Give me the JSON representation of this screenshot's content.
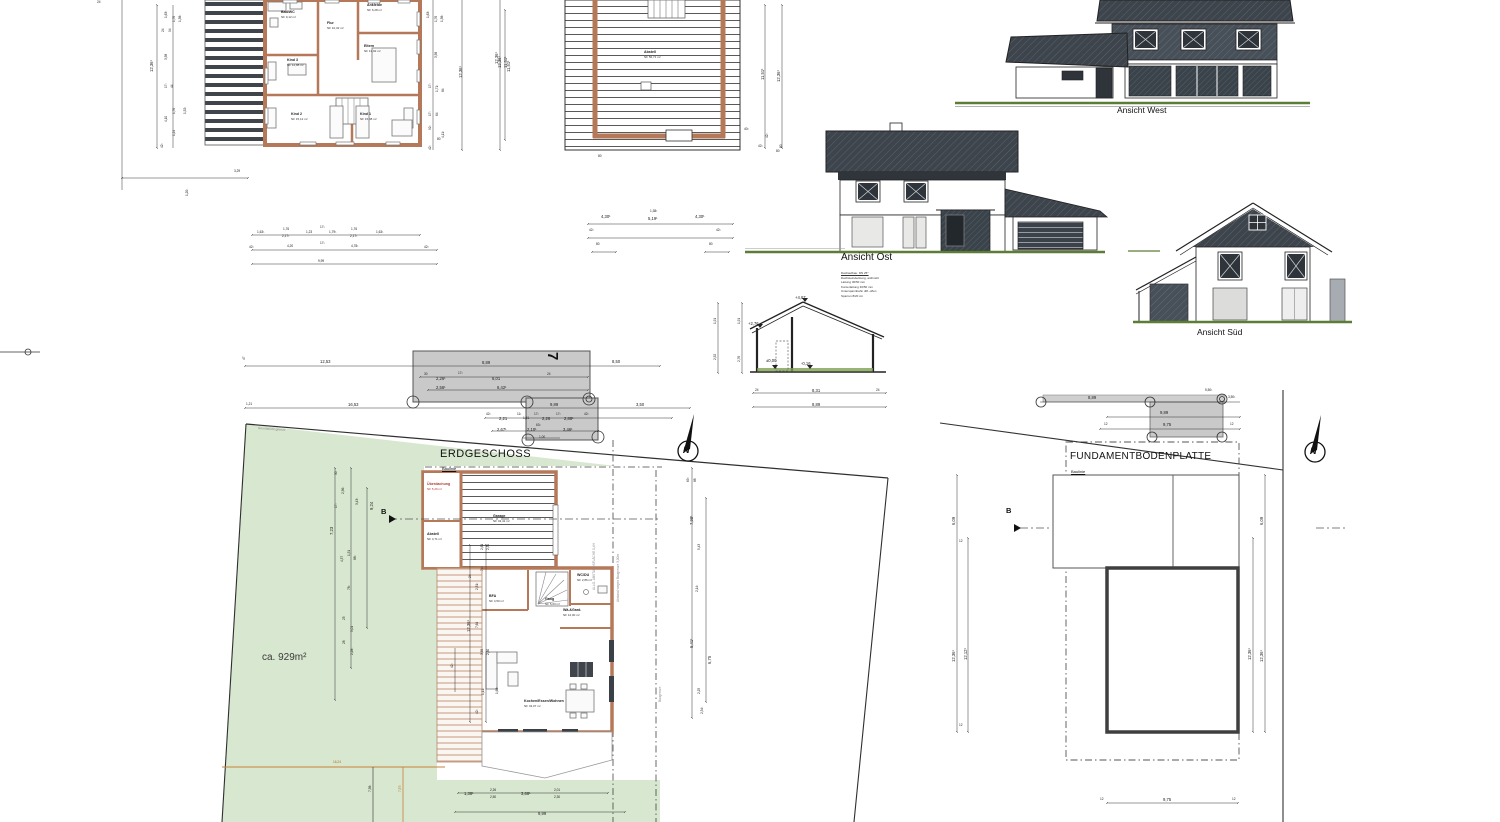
{
  "colors": {
    "wall_brown": "#b5795a",
    "roof_dark": "#3d444c",
    "plot_green": "#d8e7cf",
    "ground_green": "#5d7c37",
    "slab_gray": "#c9c9c9",
    "accent_orange": "#b06a1e",
    "accent_red": "#b03a2e"
  },
  "compass": {
    "letter": "N"
  },
  "og": {
    "rooms": [
      {
        "name": "Bad/WC",
        "area": "NF 9,12 m²"
      },
      {
        "name": "Flur",
        "area": "NF 10,32 m²"
      },
      {
        "name": "Ankleide",
        "area": "NF 6,28 m²"
      },
      {
        "name": "Eltern",
        "area": "NF 13,92 m²"
      },
      {
        "name": "Kind 3",
        "area": "NF 12,88 m²"
      },
      {
        "name": "Kind 2",
        "area": "NF 15,12 m²"
      },
      {
        "name": "Kind 1",
        "area": "NF 15,08 m²"
      }
    ],
    "dims": [
      {
        "t": "24",
        "x": 97,
        "y": 1,
        "c": "fs3"
      },
      {
        "t": "12,36¹",
        "x": 150,
        "y": 72,
        "r": -90
      },
      {
        "t": "3,58",
        "x": 165,
        "y": 60,
        "r": -90,
        "c": "fs3"
      },
      {
        "t": "24",
        "x": 162,
        "y": 32,
        "r": -90,
        "c": "fs3"
      },
      {
        "t": "94",
        "x": 169,
        "y": 32,
        "r": -90,
        "c": "fs3"
      },
      {
        "t": "1,63¹",
        "x": 165,
        "y": 18,
        "r": -90,
        "c": "fs3"
      },
      {
        "t": "1,76",
        "x": 173,
        "y": 22,
        "r": -90,
        "c": "fs3"
      },
      {
        "t": "1,38¹",
        "x": 179,
        "y": 22,
        "r": -90,
        "c": "fs3"
      },
      {
        "t": "17¹",
        "x": 165,
        "y": 88,
        "r": -90,
        "c": "fs3"
      },
      {
        "t": "44",
        "x": 171,
        "y": 88,
        "r": -90,
        "c": "fs3"
      },
      {
        "t": "4,10",
        "x": 165,
        "y": 122,
        "r": -90,
        "c": "fs3"
      },
      {
        "t": "1,76",
        "x": 173,
        "y": 114,
        "r": -90,
        "c": "fs3"
      },
      {
        "t": "1,52¹",
        "x": 184,
        "y": 114,
        "r": -90,
        "c": "fs3"
      },
      {
        "t": "1,24",
        "x": 173,
        "y": 136,
        "r": -90,
        "c": "fs3"
      },
      {
        "t": "42¹",
        "x": 161,
        "y": 148,
        "r": -90,
        "c": "fs3"
      },
      {
        "t": "1,20¹",
        "x": 186,
        "y": 196,
        "r": -90,
        "c": "fs3"
      },
      {
        "t": "3,29",
        "x": 234,
        "y": 170,
        "c": "fs3"
      },
      {
        "t": "80",
        "x": 437,
        "y": 138,
        "c": "fs3"
      },
      {
        "t": "1,63¹",
        "x": 427,
        "y": 18,
        "r": -90,
        "c": "fs3"
      },
      {
        "t": "1,76",
        "x": 435,
        "y": 22,
        "r": -90,
        "c": "fs3"
      },
      {
        "t": "1,38¹",
        "x": 441,
        "y": 22,
        "r": -90,
        "c": "fs3"
      },
      {
        "t": "3,58",
        "x": 435,
        "y": 58,
        "r": -90,
        "c": "fs3"
      },
      {
        "t": "17¹",
        "x": 429,
        "y": 88,
        "r": -90,
        "c": "fs3"
      },
      {
        "t": "1,71¹",
        "x": 436,
        "y": 92,
        "r": -90,
        "c": "fs3"
      },
      {
        "t": "84",
        "x": 442,
        "y": 92,
        "r": -90,
        "c": "fs3"
      },
      {
        "t": "17¹",
        "x": 429,
        "y": 116,
        "r": -90,
        "c": "fs3"
      },
      {
        "t": "64",
        "x": 436,
        "y": 116,
        "r": -90,
        "c": "fs3"
      },
      {
        "t": "92¹",
        "x": 429,
        "y": 130,
        "r": -90,
        "c": "fs3"
      },
      {
        "t": "4,11¹",
        "x": 442,
        "y": 138,
        "r": -90,
        "c": "fs3"
      },
      {
        "t": "42¹",
        "x": 429,
        "y": 150,
        "r": -90,
        "c": "fs3"
      },
      {
        "t": "12,36¹",
        "x": 459,
        "y": 78,
        "r": -90
      },
      {
        "t": "12,36¹",
        "x": 495,
        "y": 64,
        "r": -90
      },
      {
        "t": "11,51¹",
        "x": 504,
        "y": 68,
        "r": -90
      },
      {
        "t": "1,63¹",
        "x": 257,
        "y": 231,
        "c": "fs3"
      },
      {
        "t": "1,76",
        "x": 283,
        "y": 228,
        "c": "fs3"
      },
      {
        "t": "2,17¹",
        "x": 282,
        "y": 235,
        "c": "fs3"
      },
      {
        "t": "1,23",
        "x": 306,
        "y": 231,
        "c": "fs3"
      },
      {
        "t": "17¹",
        "x": 320,
        "y": 226,
        "c": "fs3"
      },
      {
        "t": "1,79¹",
        "x": 329,
        "y": 231,
        "c": "fs3"
      },
      {
        "t": "1,76",
        "x": 351,
        "y": 228,
        "c": "fs3"
      },
      {
        "t": "2,17¹",
        "x": 350,
        "y": 235,
        "c": "fs3"
      },
      {
        "t": "1,63¹",
        "x": 376,
        "y": 231,
        "c": "fs3"
      },
      {
        "t": "42¹",
        "x": 249,
        "y": 246,
        "c": "fs3"
      },
      {
        "t": "4,20",
        "x": 287,
        "y": 245,
        "c": "fs3"
      },
      {
        "t": "17¹",
        "x": 320,
        "y": 242,
        "c": "fs3"
      },
      {
        "t": "4,78¹",
        "x": 351,
        "y": 245,
        "c": "fs3"
      },
      {
        "t": "42¹",
        "x": 424,
        "y": 246,
        "c": "fs3"
      },
      {
        "t": "9,99",
        "x": 318,
        "y": 260,
        "c": "fs3"
      }
    ]
  },
  "dg": {
    "room": {
      "name": "Abstell",
      "area": "NF 56,71 m²"
    },
    "dims": [
      {
        "t": "12,36¹",
        "x": 498,
        "y": 68,
        "r": -90
      },
      {
        "t": "11,51¹",
        "x": 507,
        "y": 72,
        "r": -90
      },
      {
        "t": "11,51¹",
        "x": 761,
        "y": 80,
        "r": -90
      },
      {
        "t": "12,36¹",
        "x": 777,
        "y": 82,
        "r": -90
      },
      {
        "t": "42¹",
        "x": 758,
        "y": 145,
        "c": "fs3"
      },
      {
        "t": "80",
        "x": 776,
        "y": 150,
        "c": "fs3"
      },
      {
        "t": "80",
        "x": 598,
        "y": 155,
        "c": "fs3"
      },
      {
        "t": "40¹",
        "x": 744,
        "y": 128,
        "c": "fs3"
      }
    ]
  },
  "elevations": {
    "west": "Ansicht West",
    "ost": "Ansicht Ost",
    "sued": "Ansicht Süd",
    "ost_specs": [
      "Dachaufbau: DN 25°",
      "Dachsteindeckung, anthrazit",
      "Lattung 30/50 mm",
      "Konterlattung 30/50 mm",
      "Unterspannbahn diff.-offen",
      "Sparren 8/20 cm"
    ],
    "dims": [
      {
        "t": "4,30¹",
        "x": 601,
        "y": 215
      },
      {
        "t": "1,38¹",
        "x": 650,
        "y": 210,
        "c": "fs3"
      },
      {
        "t": "5,19¹",
        "x": 648,
        "y": 217
      },
      {
        "t": "4,30¹",
        "x": 695,
        "y": 215
      },
      {
        "t": "42¹",
        "x": 589,
        "y": 229,
        "c": "fs3"
      },
      {
        "t": "42¹",
        "x": 716,
        "y": 229,
        "c": "fs3"
      },
      {
        "t": "80",
        "x": 596,
        "y": 243,
        "c": "fs3"
      },
      {
        "t": "80",
        "x": 709,
        "y": 243,
        "c": "fs3"
      },
      {
        "t": "42¹",
        "x": 766,
        "y": 138,
        "r": -90,
        "c": "fs3"
      },
      {
        "t": "80",
        "x": 780,
        "y": 148,
        "r": -90,
        "c": "fs3"
      }
    ]
  },
  "section": {
    "levels": {
      "ridge": "+4,67",
      "eave": "+2,76",
      "floor": "±0,00",
      "ground": "-0,16"
    },
    "dims": [
      {
        "t": "1,91",
        "x": 714,
        "y": 324,
        "r": -90,
        "c": "fs3"
      },
      {
        "t": "2,52",
        "x": 714,
        "y": 360,
        "r": -90,
        "c": "fs3"
      },
      {
        "t": "1,91",
        "x": 738,
        "y": 324,
        "r": -90,
        "c": "fs3"
      },
      {
        "t": "2,76",
        "x": 738,
        "y": 362,
        "r": -90,
        "c": "fs3"
      },
      {
        "t": "24",
        "x": 755,
        "y": 389,
        "c": "fs3"
      },
      {
        "t": "8,31",
        "x": 812,
        "y": 389
      },
      {
        "t": "24",
        "x": 876,
        "y": 389,
        "c": "fs3"
      },
      {
        "t": "8,89",
        "x": 812,
        "y": 403
      }
    ]
  },
  "site": {
    "title": "ERDGESCHOSS",
    "baulinie": "Baulinie",
    "plot_area": "ca. 929m²",
    "neighbor_number": "7",
    "section_marker": "B",
    "rooms": [
      {
        "name": "Überdachung",
        "area": "NF 5,29 m²"
      },
      {
        "name": "Abstell",
        "area": "NF 4,71 m²"
      },
      {
        "name": "Garage",
        "area": "NF 43,41 m²"
      },
      {
        "name": "BFA",
        "area": "NF 4,50 m²"
      },
      {
        "name": "Gang",
        "area": "NF 5,03 m²"
      },
      {
        "name": "WC/DU",
        "area": "NF 2,86 m²"
      },
      {
        "name": "Wä.&Gard.",
        "area": "NF 12,00 m²"
      },
      {
        "name": "Kochen/Essen/Wohnen",
        "area": "NF 43,07 m²"
      }
    ],
    "dims": [
      {
        "t": "47",
        "x": 243,
        "y": 360,
        "r": -90,
        "c": "fs3"
      },
      {
        "t": "12,53",
        "x": 320,
        "y": 360
      },
      {
        "t": "8,89",
        "x": 482,
        "y": 361
      },
      {
        "t": "8,50",
        "x": 612,
        "y": 360
      },
      {
        "t": "30",
        "x": 424,
        "y": 373,
        "c": "fs3"
      },
      {
        "t": "2,26¹",
        "x": 436,
        "y": 377
      },
      {
        "t": "17¹",
        "x": 458,
        "y": 372,
        "c": "fs3"
      },
      {
        "t": "6,01",
        "x": 492,
        "y": 377
      },
      {
        "t": "24",
        "x": 547,
        "y": 373,
        "c": "fs3"
      },
      {
        "t": "2,56¹",
        "x": 436,
        "y": 386
      },
      {
        "t": "6,42¹",
        "x": 497,
        "y": 386
      },
      {
        "t": "1,21",
        "x": 246,
        "y": 403,
        "c": "fs3"
      },
      {
        "t": "16,53",
        "x": 348,
        "y": 403
      },
      {
        "t": "9,89",
        "x": 550,
        "y": 403
      },
      {
        "t": "3,50",
        "x": 636,
        "y": 403
      },
      {
        "t": "42¹",
        "x": 486,
        "y": 413,
        "c": "fs3"
      },
      {
        "t": "2,21",
        "x": 499,
        "y": 417
      },
      {
        "t": "11¹",
        "x": 517,
        "y": 413,
        "c": "fs3"
      },
      {
        "t": "1,61",
        "x": 523,
        "y": 417,
        "c": "fs3"
      },
      {
        "t": "17¹",
        "x": 534,
        "y": 413,
        "c": "fs3"
      },
      {
        "t": "2,26",
        "x": 542,
        "y": 417
      },
      {
        "t": "17¹",
        "x": 556,
        "y": 413,
        "c": "fs3"
      },
      {
        "t": "2,88¹",
        "x": 564,
        "y": 417
      },
      {
        "t": "42¹",
        "x": 584,
        "y": 413,
        "c": "fs3"
      },
      {
        "t": "2,67¹",
        "x": 497,
        "y": 428
      },
      {
        "t": "2,10¹",
        "x": 527,
        "y": 428
      },
      {
        "t": "63¹",
        "x": 536,
        "y": 424,
        "c": "fs3"
      },
      {
        "t": "3,46¹",
        "x": 563,
        "y": 428
      },
      {
        "t": "1,00",
        "x": 539,
        "y": 436,
        "c": "fs3"
      },
      {
        "t": "30",
        "x": 335,
        "y": 475,
        "r": -90,
        "c": "fs3"
      },
      {
        "t": "2,36¹",
        "x": 342,
        "y": 494,
        "r": -90,
        "c": "fs3"
      },
      {
        "t": "17¹",
        "x": 335,
        "y": 508,
        "r": -90,
        "c": "fs3"
      },
      {
        "t": "3,43¹",
        "x": 356,
        "y": 505,
        "r": -90,
        "c": "fs3"
      },
      {
        "t": "7,23",
        "x": 330,
        "y": 535,
        "r": -90
      },
      {
        "t": "4,37",
        "x": 341,
        "y": 562,
        "r": -90,
        "c": "fs3"
      },
      {
        "t": "1,51",
        "x": 348,
        "y": 556,
        "r": -90,
        "c": "fs3"
      },
      {
        "t": "88¹",
        "x": 354,
        "y": 560,
        "r": -90,
        "c": "fs3"
      },
      {
        "t": "78¹",
        "x": 348,
        "y": 590,
        "r": -90,
        "c": "fs3"
      },
      {
        "t": "25",
        "x": 343,
        "y": 620,
        "r": -90,
        "c": "fs3"
      },
      {
        "t": "5,01",
        "x": 351,
        "y": 632,
        "r": -90,
        "c": "fs3"
      },
      {
        "t": "28",
        "x": 343,
        "y": 644,
        "r": -90,
        "c": "fs3"
      },
      {
        "t": "2,28¹",
        "x": 351,
        "y": 655,
        "r": -90,
        "c": "fs3"
      },
      {
        "t": "9,24",
        "x": 370,
        "y": 510,
        "r": -90
      },
      {
        "t": "42¹",
        "x": 451,
        "y": 668,
        "r": -90,
        "c": "fs3"
      },
      {
        "t": "24",
        "x": 469,
        "y": 578,
        "r": -90,
        "c": "fs3"
      },
      {
        "t": "2,31¹",
        "x": 476,
        "y": 590,
        "r": -90,
        "c": "fs3"
      },
      {
        "t": "2,61",
        "x": 481,
        "y": 550,
        "r": -90,
        "c": "fs3"
      },
      {
        "t": "2,30",
        "x": 487,
        "y": 550,
        "r": -90,
        "c": "fs3"
      },
      {
        "t": "74¹",
        "x": 481,
        "y": 571,
        "r": -90,
        "c": "fs3"
      },
      {
        "t": "12,36¹",
        "x": 467,
        "y": 632,
        "r": -90
      },
      {
        "t": "7,64",
        "x": 476,
        "y": 628,
        "r": -90,
        "c": "fs3"
      },
      {
        "t": "3,55",
        "x": 481,
        "y": 655,
        "r": -90,
        "c": "fs3"
      },
      {
        "t": "2,30",
        "x": 487,
        "y": 655,
        "r": -90,
        "c": "fs3"
      },
      {
        "t": "1,11¹",
        "x": 482,
        "y": 695,
        "r": -90,
        "c": "fs3"
      },
      {
        "t": "42¹",
        "x": 476,
        "y": 714,
        "r": -90,
        "c": "fs3"
      },
      {
        "t": "1,68¹",
        "x": 496,
        "y": 694,
        "r": -90,
        "c": "fs3"
      },
      {
        "t": "69¹",
        "x": 687,
        "y": 482,
        "r": -90,
        "c": "fs3"
      },
      {
        "t": "88",
        "x": 694,
        "y": 482,
        "r": -90,
        "c": "fs3"
      },
      {
        "t": "7,98¹",
        "x": 690,
        "y": 525,
        "r": -90
      },
      {
        "t": "5,43",
        "x": 698,
        "y": 550,
        "r": -90,
        "c": "fs3"
      },
      {
        "t": "2,14¹",
        "x": 696,
        "y": 592,
        "r": -90,
        "c": "fs3"
      },
      {
        "t": "5,41¹",
        "x": 690,
        "y": 648,
        "r": -90
      },
      {
        "t": "2,25",
        "x": 698,
        "y": 694,
        "r": -90,
        "c": "fs3"
      },
      {
        "t": "6,75",
        "x": 708,
        "y": 664,
        "r": -90
      },
      {
        "t": "2,34¹",
        "x": 701,
        "y": 714,
        "r": -90,
        "c": "fs3"
      },
      {
        "t": "ALLG. ABSTANDSFLÄCHE 0,4H",
        "x": 593,
        "y": 590,
        "r": -90,
        "c": "fs3 gray"
      },
      {
        "t": "Abstand wegen Baugrenze 3,00m",
        "x": 617,
        "y": 602,
        "r": -90,
        "c": "fs3 gray"
      },
      {
        "t": "Baugrenze",
        "x": 659,
        "y": 702,
        "r": -90,
        "c": "fs3 gray"
      },
      {
        "t": "Grundstücksgrenze",
        "x": 258,
        "y": 427,
        "r": 4,
        "c": "fs3 gray"
      },
      {
        "t": "16,24",
        "x": 333,
        "y": 761,
        "c": "fs3 orange"
      },
      {
        "t": "7,38¹",
        "x": 369,
        "y": 792,
        "r": -90,
        "c": "fs3"
      },
      {
        "t": "7,37¹",
        "x": 399,
        "y": 792,
        "r": -90,
        "c": "fs3 orange"
      },
      {
        "t": "1,38¹",
        "x": 464,
        "y": 792
      },
      {
        "t": "2,26",
        "x": 490,
        "y": 789,
        "c": "fs3"
      },
      {
        "t": "2,50",
        "x": 490,
        "y": 796,
        "c": "fs3"
      },
      {
        "t": "3,68¹",
        "x": 521,
        "y": 792
      },
      {
        "t": "2,01",
        "x": 554,
        "y": 789,
        "c": "fs3"
      },
      {
        "t": "2,30",
        "x": 554,
        "y": 796,
        "c": "fs3"
      },
      {
        "t": "9,99",
        "x": 538,
        "y": 812
      }
    ]
  },
  "foundation": {
    "title": "FUNDAMENTBODENPLATTE",
    "baulinie": "Baulinie",
    "section_marker": "B",
    "dims": [
      {
        "t": "8,89",
        "x": 1088,
        "y": 396
      },
      {
        "t": "5,50¹",
        "x": 1205,
        "y": 389,
        "c": "fs3"
      },
      {
        "t": "3,50¹",
        "x": 1228,
        "y": 396,
        "c": "fs3"
      },
      {
        "t": "9,89",
        "x": 1160,
        "y": 411
      },
      {
        "t": "12",
        "x": 1104,
        "y": 423,
        "c": "fs3"
      },
      {
        "t": "9,75",
        "x": 1163,
        "y": 423
      },
      {
        "t": "12",
        "x": 1230,
        "y": 423,
        "c": "fs3"
      },
      {
        "t": "6,09",
        "x": 952,
        "y": 525,
        "r": -90
      },
      {
        "t": "12,36¹",
        "x": 952,
        "y": 662,
        "r": -90
      },
      {
        "t": "12,12¹",
        "x": 964,
        "y": 660,
        "r": -90
      },
      {
        "t": "12",
        "x": 959,
        "y": 540,
        "c": "fs3"
      },
      {
        "t": "12",
        "x": 959,
        "y": 724,
        "c": "fs3"
      },
      {
        "t": "12,36¹",
        "x": 1248,
        "y": 660,
        "r": -90
      },
      {
        "t": "6,09",
        "x": 1260,
        "y": 525,
        "r": -90
      },
      {
        "t": "12,36¹",
        "x": 1260,
        "y": 662,
        "r": -90
      },
      {
        "t": "12",
        "x": 1100,
        "y": 798,
        "c": "fs3"
      },
      {
        "t": "9,75",
        "x": 1163,
        "y": 798
      },
      {
        "t": "12",
        "x": 1232,
        "y": 798,
        "c": "fs3"
      }
    ]
  }
}
